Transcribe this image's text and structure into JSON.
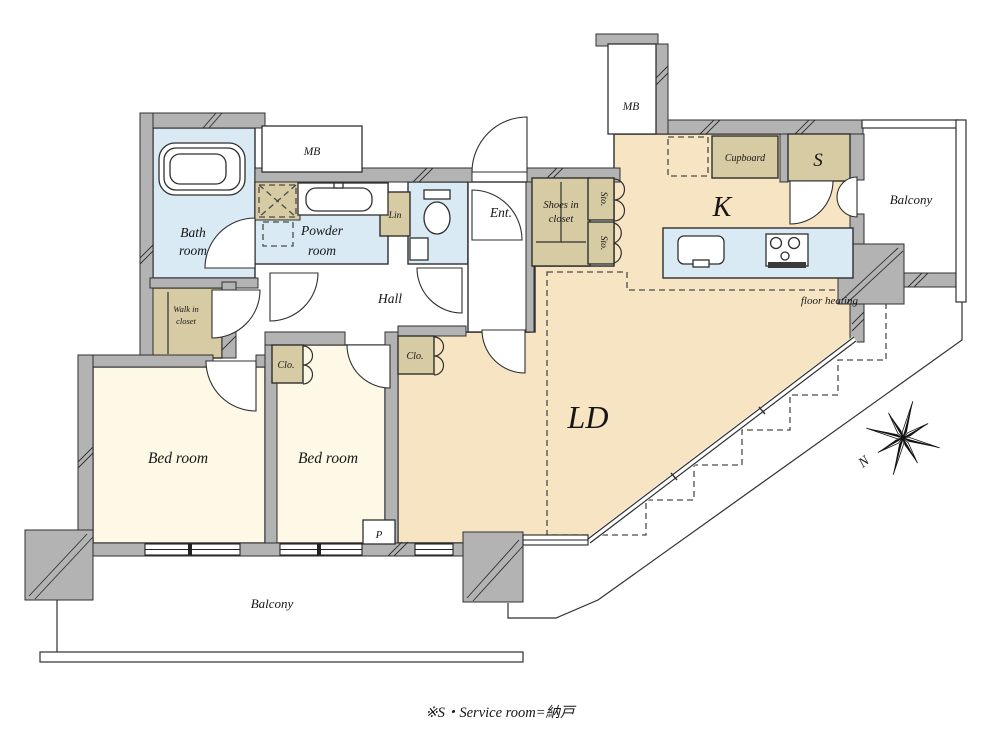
{
  "colors": {
    "wall": "#b3b3b3",
    "wet_room_blue": "#d9eaf5",
    "bedroom_cream": "#fdf9e6",
    "living_peach": "#f7e4c3",
    "closet_tan": "#d7cba4",
    "outline": "#2f2f2f"
  },
  "labels": {
    "bath_line1": "Bath",
    "bath_line2": "room",
    "mb_left": "MB",
    "mb_top": "MB",
    "powder_line1": "Powder",
    "powder_line2": "room",
    "lin": "Lin",
    "ent": "Ent.",
    "shoes_line1": "Shoes in",
    "shoes_line2": "closet",
    "sto_upper": "Sto.",
    "sto_lower": "Sto.",
    "cupboard": "Cupboard",
    "service_room": "S",
    "kitchen": "K",
    "balcony_right": "Balcony",
    "floor_heating": "floor heating",
    "living_dining": "LD",
    "hall": "Hall",
    "walkin_line1": "Walk in",
    "walkin_line2": "closet",
    "clo_bedroom2": "Clo.",
    "clo_ld": "Clo.",
    "bedroom_left": "Bed room",
    "bedroom_center": "Bed room",
    "pipe_space": "P",
    "balcony_bottom": "Balcony",
    "compass_north": "N",
    "note": "※S・Service room=納戸"
  }
}
